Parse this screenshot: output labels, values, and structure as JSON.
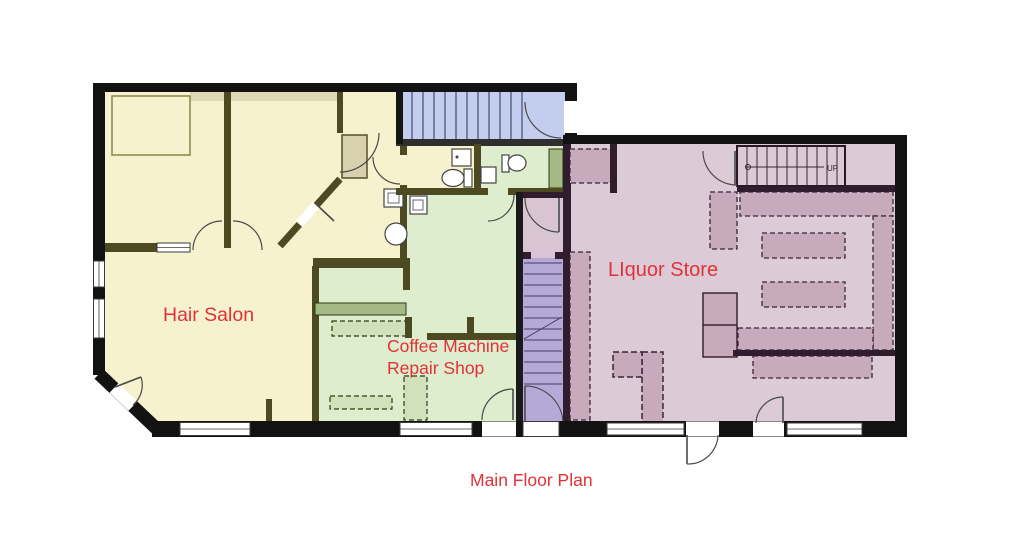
{
  "title": "Main Floor Plan",
  "rooms": {
    "hair_salon": {
      "label": "Hair Salon"
    },
    "coffee_shop": {
      "label_line1": "Coffee Machine",
      "label_line2": "Repair Shop"
    },
    "liquor_store": {
      "label": "LIquor Store"
    }
  },
  "stairs": {
    "up_label": "UP"
  },
  "colors": {
    "background": "#ffffff",
    "label_red": "#e13238",
    "wall_black": "#121212",
    "wall_olive": "#4d4a22",
    "wall_eggplant": "#301c2c",
    "hair_salon_floor": "#f5f2cd",
    "coffee_floor": "#ddedcd",
    "counter_green": "#a3ba84",
    "counter_light": "#cfe2bb",
    "closet_tan": "#d8d1ae",
    "entry_stairs_blue": "#c3cdee",
    "stairwell_lavender": "#b5aad7",
    "vestibule_mauve": "#d8c4d3",
    "liquor_floor": "#dccbd6",
    "liquor_shelf": "#c7abbc"
  }
}
